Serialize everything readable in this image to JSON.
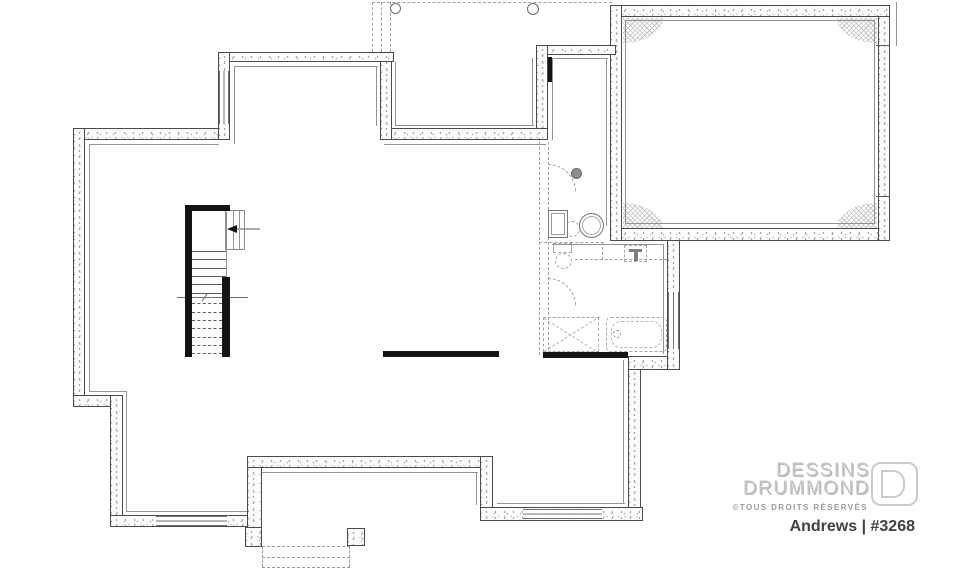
{
  "branding": {
    "line1": "DESSINS",
    "line2": "DRUMMOND",
    "rights": "©TOUS DROITS RÉSERVÉS",
    "plan_label": "Andrews | #3268"
  },
  "colors": {
    "wall_outline": "#4b4b4b",
    "stipple_dots": "#9f9f9f",
    "interior_finish_line": "#949494",
    "dashed_future_work": "#9f9f9f",
    "solid_black_elements": "#141414",
    "hatch_gray": "#c2c2c2",
    "logo_gray": "#c3c3c3",
    "tagline_gray": "#9b9b9b",
    "plan_label_color": "#414141"
  },
  "plan_symbols": [
    "concrete-foundation-wall",
    "window",
    "staircase",
    "stair-direction-arrow",
    "stair-break-line",
    "future-bathroom-partition-dashed",
    "door-swing-arc",
    "future-toilet",
    "future-shower",
    "future-bathtub",
    "water-heater",
    "furnace",
    "floor-drain",
    "plumbing-rough-in",
    "beam-line",
    "deck-outline-dashed",
    "deck-post",
    "support-pier",
    "exterior-stoop-dashed",
    "hatched-wall-corner"
  ]
}
